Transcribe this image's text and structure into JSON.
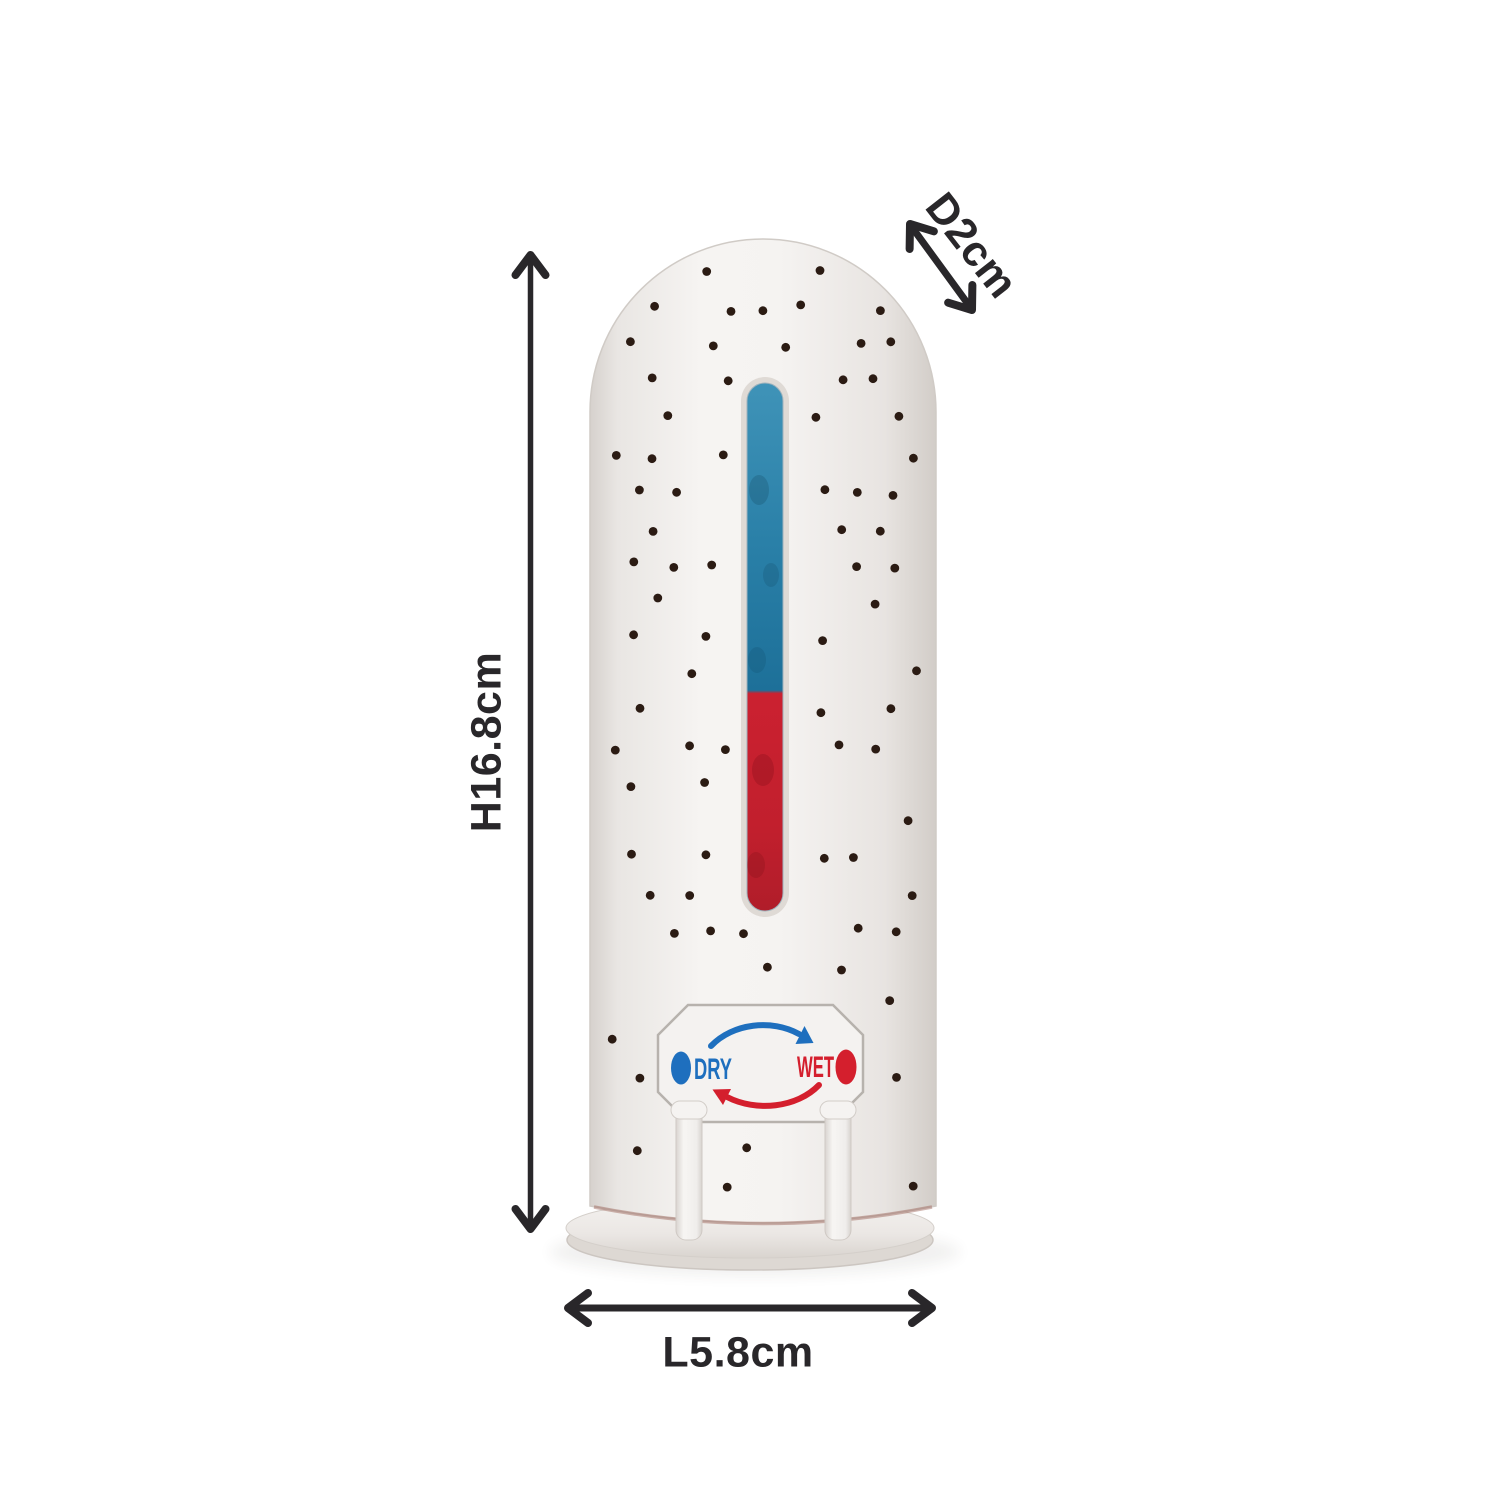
{
  "page": {
    "background_color": "#ffffff"
  },
  "dimensions": {
    "arrow_color": "#29272a",
    "height": {
      "label": "H16.8cm"
    },
    "length": {
      "label": "L5.8cm"
    },
    "depth": {
      "label": "D2cm"
    }
  },
  "device": {
    "type": "mini dehumidifier",
    "body_color": "#f5f3f1",
    "hole_color": "#2b1b13",
    "indicator_window": {
      "dry_color": "#2a80a8",
      "wet_color": "#cb2130",
      "dry_fraction": "59%"
    },
    "label_panel": {
      "dry_text": "DRY",
      "dry_color": "#1e6fbe",
      "wet_text": "WET",
      "wet_color": "#d41f2d"
    }
  }
}
